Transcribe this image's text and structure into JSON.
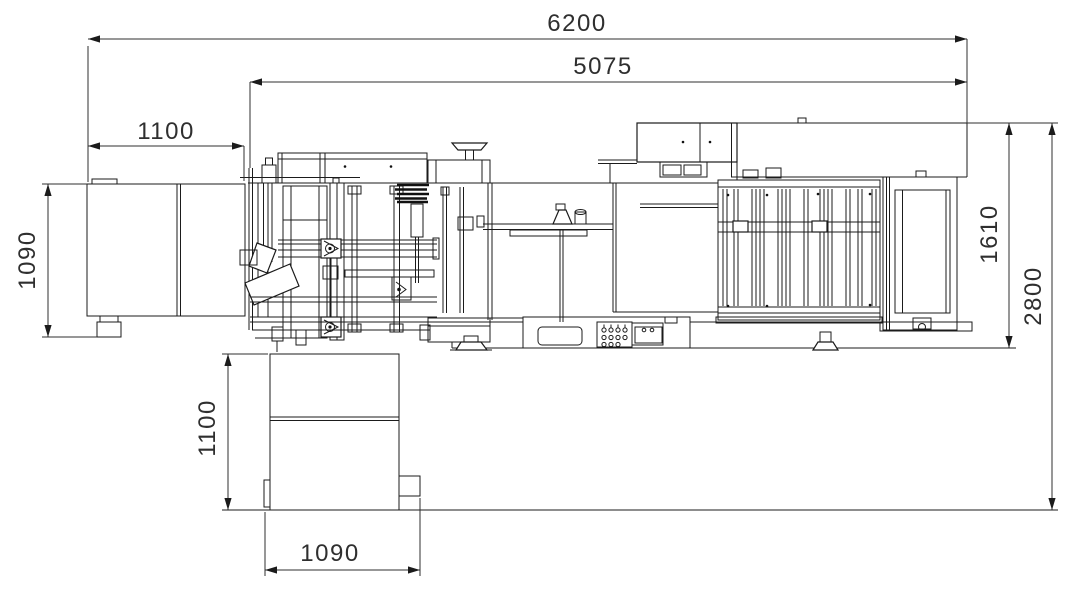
{
  "drawing": {
    "kind": "machine-plan-view-technical-drawing",
    "colors": {
      "background": "#ffffff",
      "line": "#1b1b1b",
      "dimension": "#2f2f2f"
    }
  },
  "dimensions": {
    "overall_length": "6200",
    "machine_length": "5075",
    "left_unit_offset": "1100",
    "left_unit_depth": "1090",
    "machine_depth": "1610",
    "overall_depth": "2800",
    "bottom_unit_depth": "1100",
    "bottom_unit_width": "1090"
  }
}
